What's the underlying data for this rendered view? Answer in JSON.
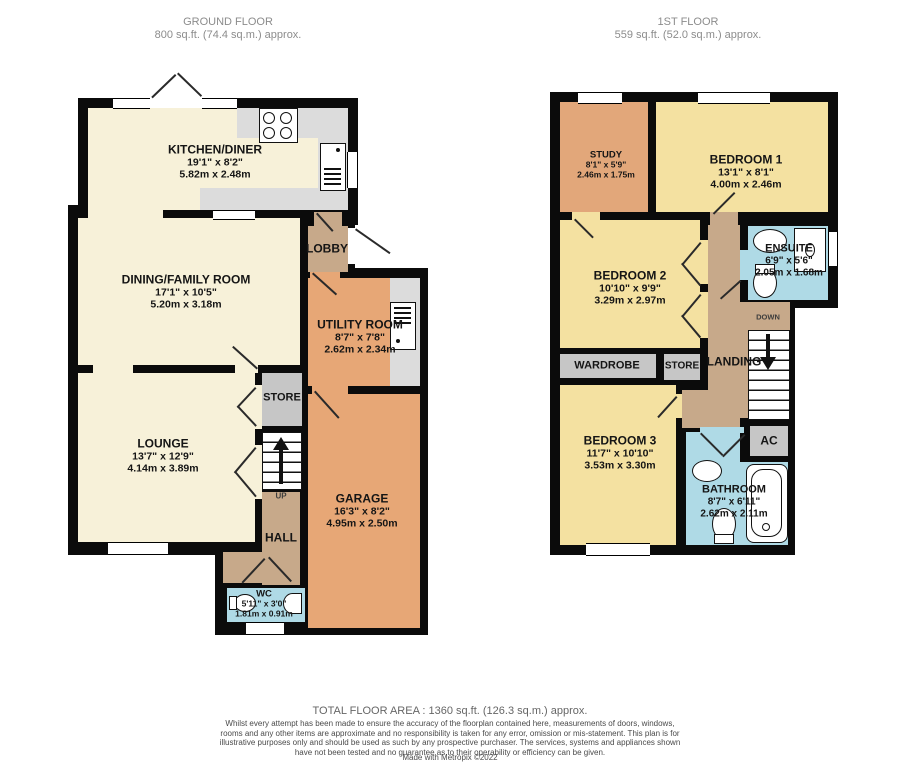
{
  "ground": {
    "title": "GROUND FLOOR",
    "subtitle": "800 sq.ft. (74.4 sq.m.) approx.",
    "rooms": {
      "kitchen": {
        "name": "KITCHEN/DINER",
        "imperial": "19'1\" x 8'2\"",
        "metric": "5.82m x 2.48m"
      },
      "dining": {
        "name": "DINING/FAMILY ROOM",
        "imperial": "17'1\" x 10'5\"",
        "metric": "5.20m x 3.18m"
      },
      "lobby": {
        "name": "LOBBY"
      },
      "utility": {
        "name": "UTILITY ROOM",
        "imperial": "8'7\" x 7'8\"",
        "metric": "2.62m x 2.34m"
      },
      "store": {
        "name": "STORE"
      },
      "lounge": {
        "name": "LOUNGE",
        "imperial": "13'7\" x 12'9\"",
        "metric": "4.14m x 3.89m"
      },
      "up": {
        "name": "UP"
      },
      "hall": {
        "name": "HALL"
      },
      "garage": {
        "name": "GARAGE",
        "imperial": "16'3\" x 8'2\"",
        "metric": "4.95m x 2.50m"
      },
      "wc": {
        "name": "WC",
        "imperial": "5'11\" x 3'0\"",
        "metric": "1.81m x 0.91m"
      }
    }
  },
  "first": {
    "title": "1ST FLOOR",
    "subtitle": "559 sq.ft. (52.0 sq.m.) approx.",
    "rooms": {
      "study": {
        "name": "STUDY",
        "imperial": "8'1\" x 5'9\"",
        "metric": "2.46m x 1.75m"
      },
      "bedroom1": {
        "name": "BEDROOM 1",
        "imperial": "13'1\" x 8'1\"",
        "metric": "4.00m x 2.46m"
      },
      "ensuite": {
        "name": "ENSUITE",
        "imperial": "6'9\" x 5'6\"",
        "metric": "2.05m x 1.68m"
      },
      "bedroom2": {
        "name": "BEDROOM 2",
        "imperial": "10'10\" x 9'9\"",
        "metric": "3.29m x 2.97m"
      },
      "wardrobe": {
        "name": "WARDROBE"
      },
      "store": {
        "name": "STORE"
      },
      "landing": {
        "name": "LANDING"
      },
      "down": {
        "name": "DOWN"
      },
      "bedroom3": {
        "name": "BEDROOM 3",
        "imperial": "11'7\" x 10'10\"",
        "metric": "3.53m x 3.30m"
      },
      "bathroom": {
        "name": "BATHROOM",
        "imperial": "8'7\" x 6'11\"",
        "metric": "2.62m x 2.11m"
      },
      "ac": {
        "name": "AC"
      }
    }
  },
  "footer": {
    "total_area": "TOTAL FLOOR AREA : 1360 sq.ft. (126.3 sq.m.) approx.",
    "disclaimer": "Whilst every attempt has been made to ensure the accuracy of the floorplan contained here, measurements of doors, windows, rooms and any other items are approximate and no responsibility is taken for any error, omission or mis-statement. This plan is for illustrative purposes only and should be used as such by any prospective purchaser. The services, systems and appliances shown have not been tested and no guarantee as to their operability or efficiency can be given.",
    "credit": "Made with Metropix ©2022"
  },
  "colors": {
    "wall": "#0b0b0b",
    "reception_cream": "#F7F1D9",
    "bedroom_yellow": "#F4E1A1",
    "garage_orange": "#E7A776",
    "study_orange": "#E2A77A",
    "hall_tan": "#C7A98A",
    "bathroom_blue": "#AFDAE6",
    "store_gray": "#C6C6C6",
    "counter_gray": "#DCDCDC",
    "title_gray": "#8C8C8C"
  }
}
